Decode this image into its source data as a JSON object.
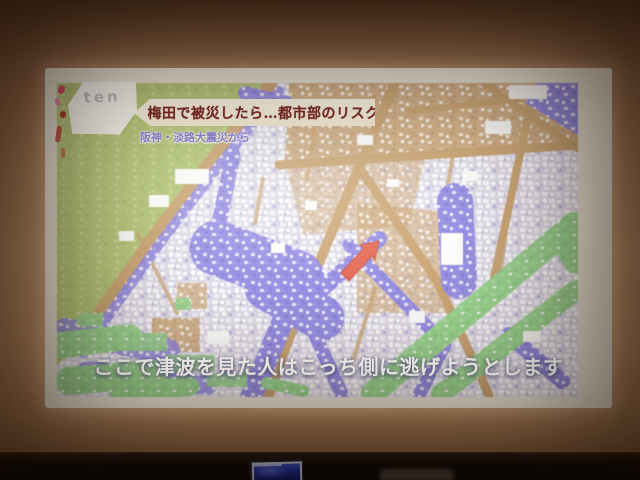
{
  "broadcast": {
    "logo_text": "ten",
    "headline": "梅田で被災したら…都市部のリスク",
    "subheadline": "阪神・淡路大震災から",
    "caption": "ここで津波を見た人はこっち側に逃げようとします"
  },
  "map": {
    "arrow_direction": "northeast",
    "colors": {
      "flood_water": "#8d84e2",
      "roads": "#c79f6a",
      "hillside_green": "#b2c470",
      "riverside_green": "#92d189",
      "buildings": "#ffffff",
      "city_base": "#dcd8e8",
      "arrow": "#e2604a"
    }
  }
}
